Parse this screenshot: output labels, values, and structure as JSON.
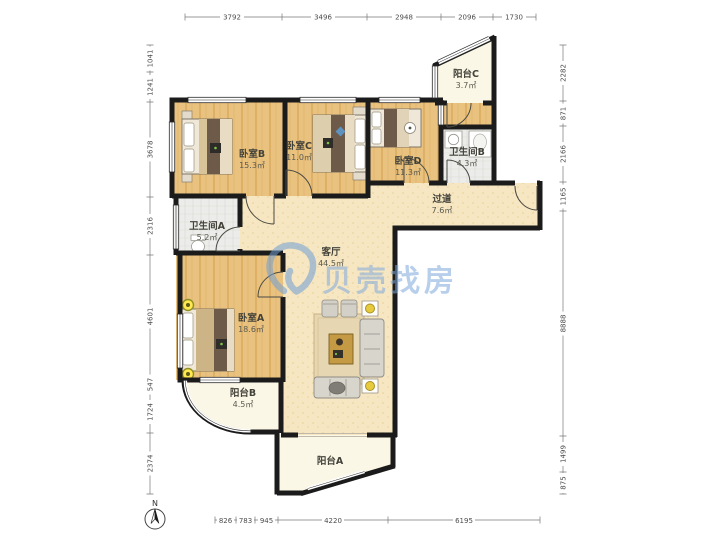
{
  "watermark": {
    "brand": "贝壳找房",
    "color": "#7fa9dd"
  },
  "compass": {
    "label": "N"
  },
  "rooms": {
    "bedroomA": {
      "name": "卧室A",
      "area": "18.6㎡"
    },
    "bedroomB": {
      "name": "卧室B",
      "area": "15.3㎡"
    },
    "bedroomC": {
      "name": "卧室C",
      "area": "11.0㎡"
    },
    "bedroomD": {
      "name": "卧室D",
      "area": "11.3㎡"
    },
    "bathroomA": {
      "name": "卫生间A",
      "area": "5.2㎡"
    },
    "bathroomB": {
      "name": "卫生间B",
      "area": "4.3㎡"
    },
    "livingRoom": {
      "name": "客厅",
      "area": "44.5㎡"
    },
    "hallway": {
      "name": "过道",
      "area": "7.6㎡"
    },
    "balconyA": {
      "name": "阳台A",
      "area": ""
    },
    "balconyB": {
      "name": "阳台B",
      "area": "4.5㎡"
    },
    "balconyC": {
      "name": "阳台C",
      "area": "3.7㎡"
    }
  },
  "dimensions": {
    "top": [
      "3792",
      "3496",
      "2948",
      "2096",
      "1730"
    ],
    "left": [
      "1041",
      "1241",
      "3678",
      "2316",
      "4601",
      "547",
      "1724",
      "2374"
    ],
    "right": [
      "2282",
      "871",
      "2166",
      "1165",
      "8888",
      "1499",
      "875"
    ],
    "bottom": [
      "826",
      "783",
      "945",
      "4220",
      "6195"
    ]
  },
  "colors": {
    "wall": "#1b1b1b",
    "woodFloor": "#eac27f",
    "livingFloor": "#f6e7c2",
    "balconyFloor": "#fbf7e6",
    "tileFloor": "#ececea"
  }
}
